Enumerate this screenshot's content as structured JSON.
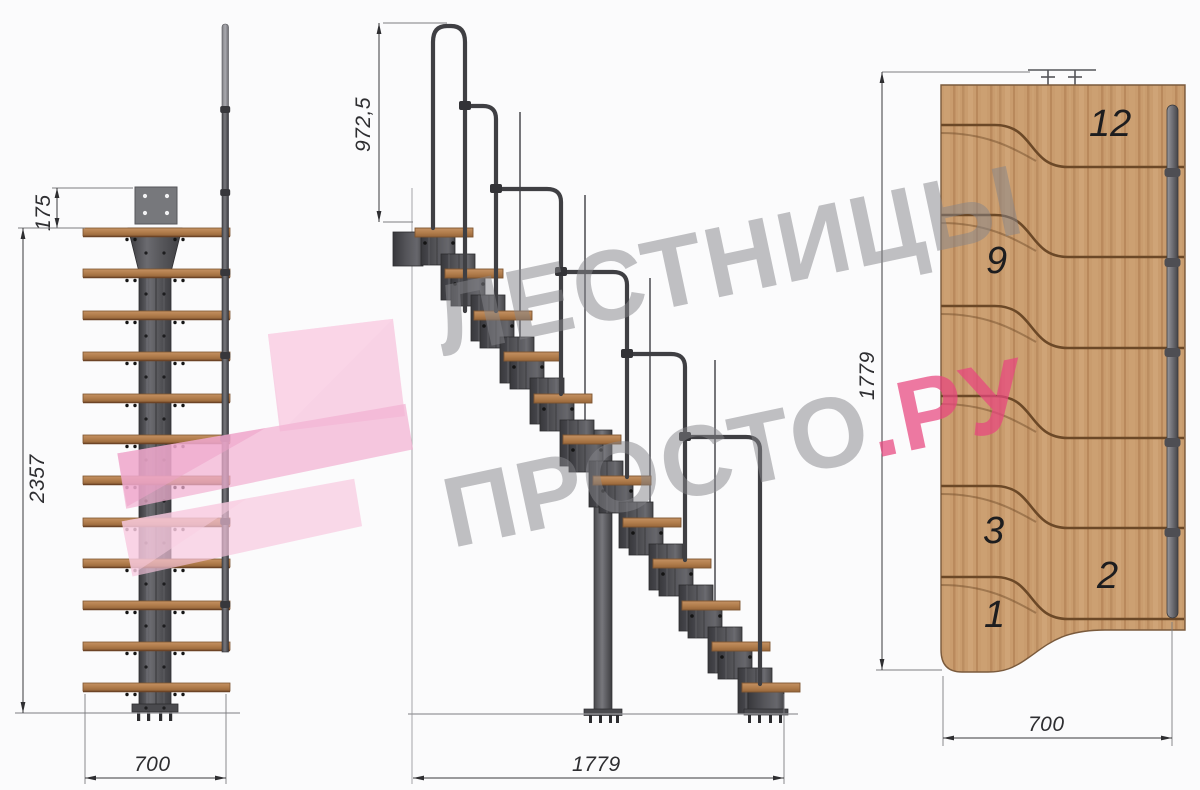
{
  "drawing_title": "Modular staircase technical drawing (front, side and plan views)",
  "watermark": {
    "line1": "ЛЕСТНИЦЫ",
    "line2_gray": "ПРОСТО",
    "line2_pink": ".РУ",
    "gray_color": "#85858a",
    "pink_color": "#e9467f",
    "logo_pink": "#f5c0da"
  },
  "front_view": {
    "dim_plate_offset": "175",
    "dim_total_height": "2357",
    "dim_width": "700"
  },
  "side_view": {
    "dim_handrail_height": "972,5",
    "dim_total_length": "1779"
  },
  "plan_view": {
    "dim_total_length": "1779",
    "dim_width": "700",
    "tread_numbers": [
      "12",
      "9",
      "3",
      "2",
      "1"
    ]
  },
  "colors": {
    "steel_dark": "#434347",
    "steel_mid": "#5c5c60",
    "steel_light": "#8f8f94",
    "wood_tread": "#b9834f",
    "wood_plan": "#c99c6e",
    "separator_brown": "#6b4827",
    "dim_line": "#3a3a3c",
    "background": "#fbfbfc"
  }
}
